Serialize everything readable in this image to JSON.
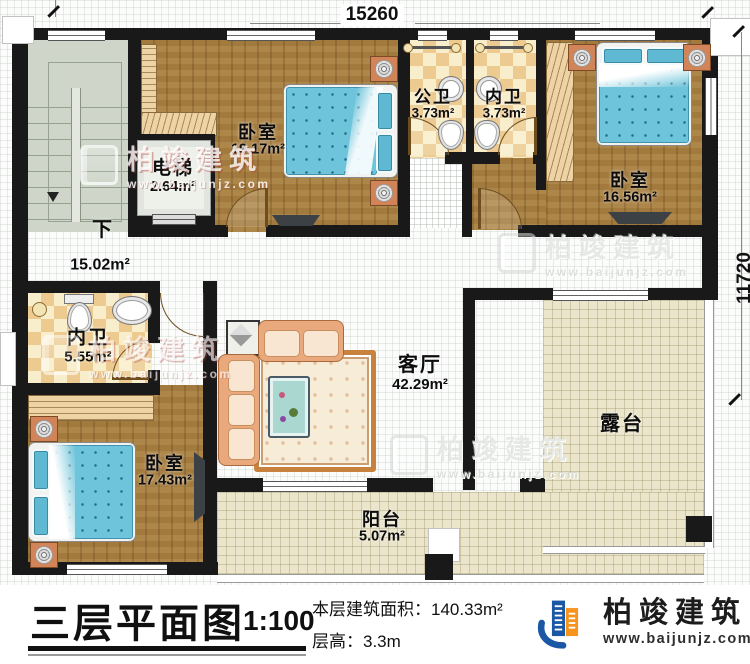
{
  "plan": {
    "dimensions": {
      "width": "15260",
      "height": "11720"
    },
    "rooms": {
      "stairs": {
        "down_label": "下"
      },
      "elevator": {
        "name": "电梯",
        "area": "2.64m²"
      },
      "bedroom_top": {
        "name": "卧室",
        "area": "19.17m²"
      },
      "public_bath": {
        "name": "公卫",
        "area": "3.73m²"
      },
      "ensuite_top": {
        "name": "内卫",
        "area": "3.73m²"
      },
      "bedroom_right": {
        "name": "卧室",
        "area": "16.56m²"
      },
      "hallway": {
        "area": "15.02m²"
      },
      "ensuite_left": {
        "name": "内卫",
        "area": "5.55m²"
      },
      "bedroom_bottom": {
        "name": "卧室",
        "area": "17.43m²"
      },
      "living_room": {
        "name": "客厅",
        "area": "42.29m²"
      },
      "terrace": {
        "name": "露台"
      },
      "balcony": {
        "name": "阳台",
        "area": "5.07m²"
      }
    }
  },
  "title_block": {
    "title": "三层平面图",
    "scale": "1:100",
    "area_line": "本层建筑面积：140.33m²",
    "height_line": "层高：3.3m"
  },
  "branding": {
    "company": "柏竣建筑",
    "website": "www.baijunjz.com",
    "logo_blue": "#1b57a4",
    "logo_orange": "#f7941d"
  }
}
